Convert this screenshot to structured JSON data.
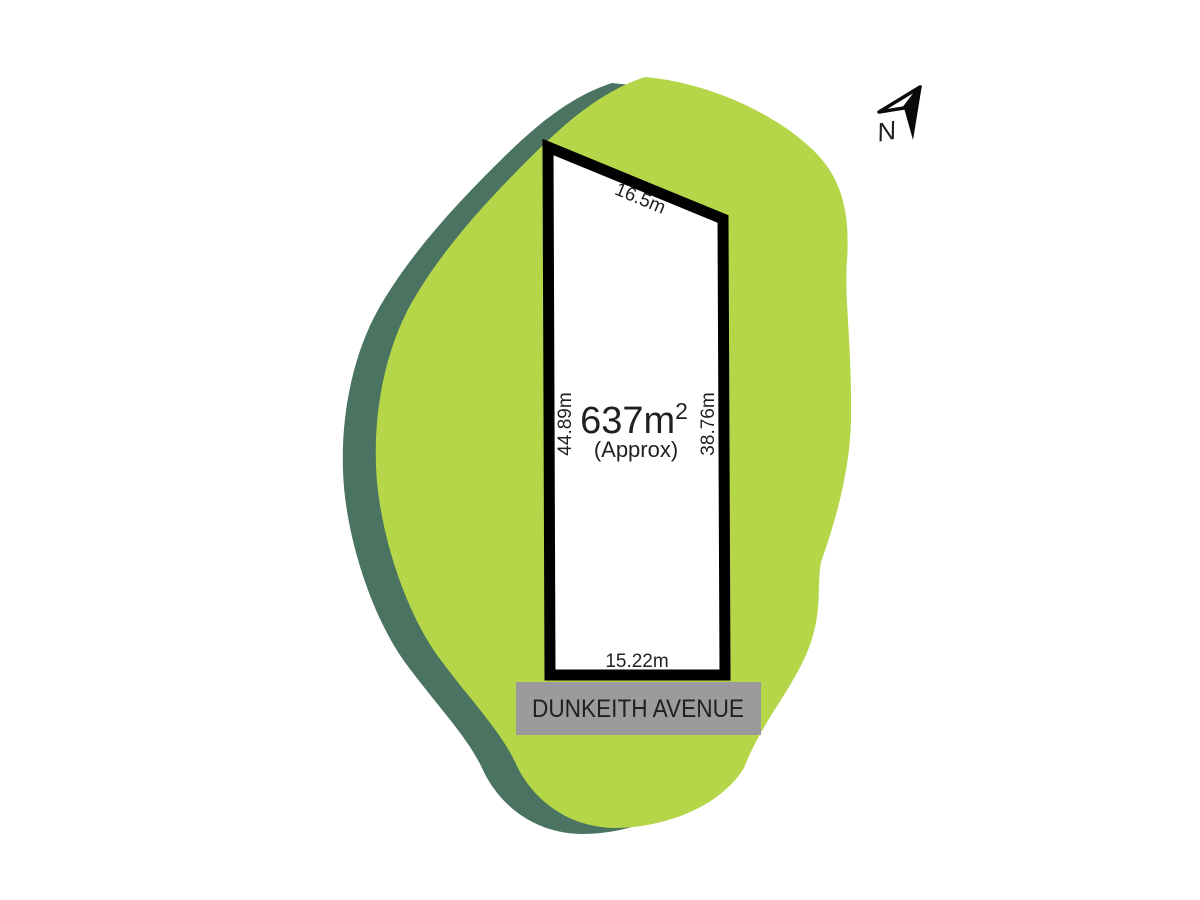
{
  "diagram": {
    "type": "land-lot-plan",
    "north_arrow": {
      "label": "N"
    },
    "plot": {
      "area_value": "637m",
      "area_superscript": "2",
      "area_note": "(Approx)",
      "dimensions": {
        "top": "16.5m",
        "left": "44.89m",
        "right": "38.76m",
        "bottom": "15.22m"
      }
    },
    "street": {
      "name": "DUNKEITH AVENUE"
    }
  },
  "colors": {
    "background": "#ffffff",
    "site_fill": "#b5d648",
    "site_shadow": "#4a7461",
    "plot_fill": "#ffffff",
    "plot_border": "#010101",
    "street_banner": "#9b9b9e",
    "street_text": "#2e2d2e",
    "label_text": "#231f20",
    "north_arrow": "#0a0a0a"
  }
}
